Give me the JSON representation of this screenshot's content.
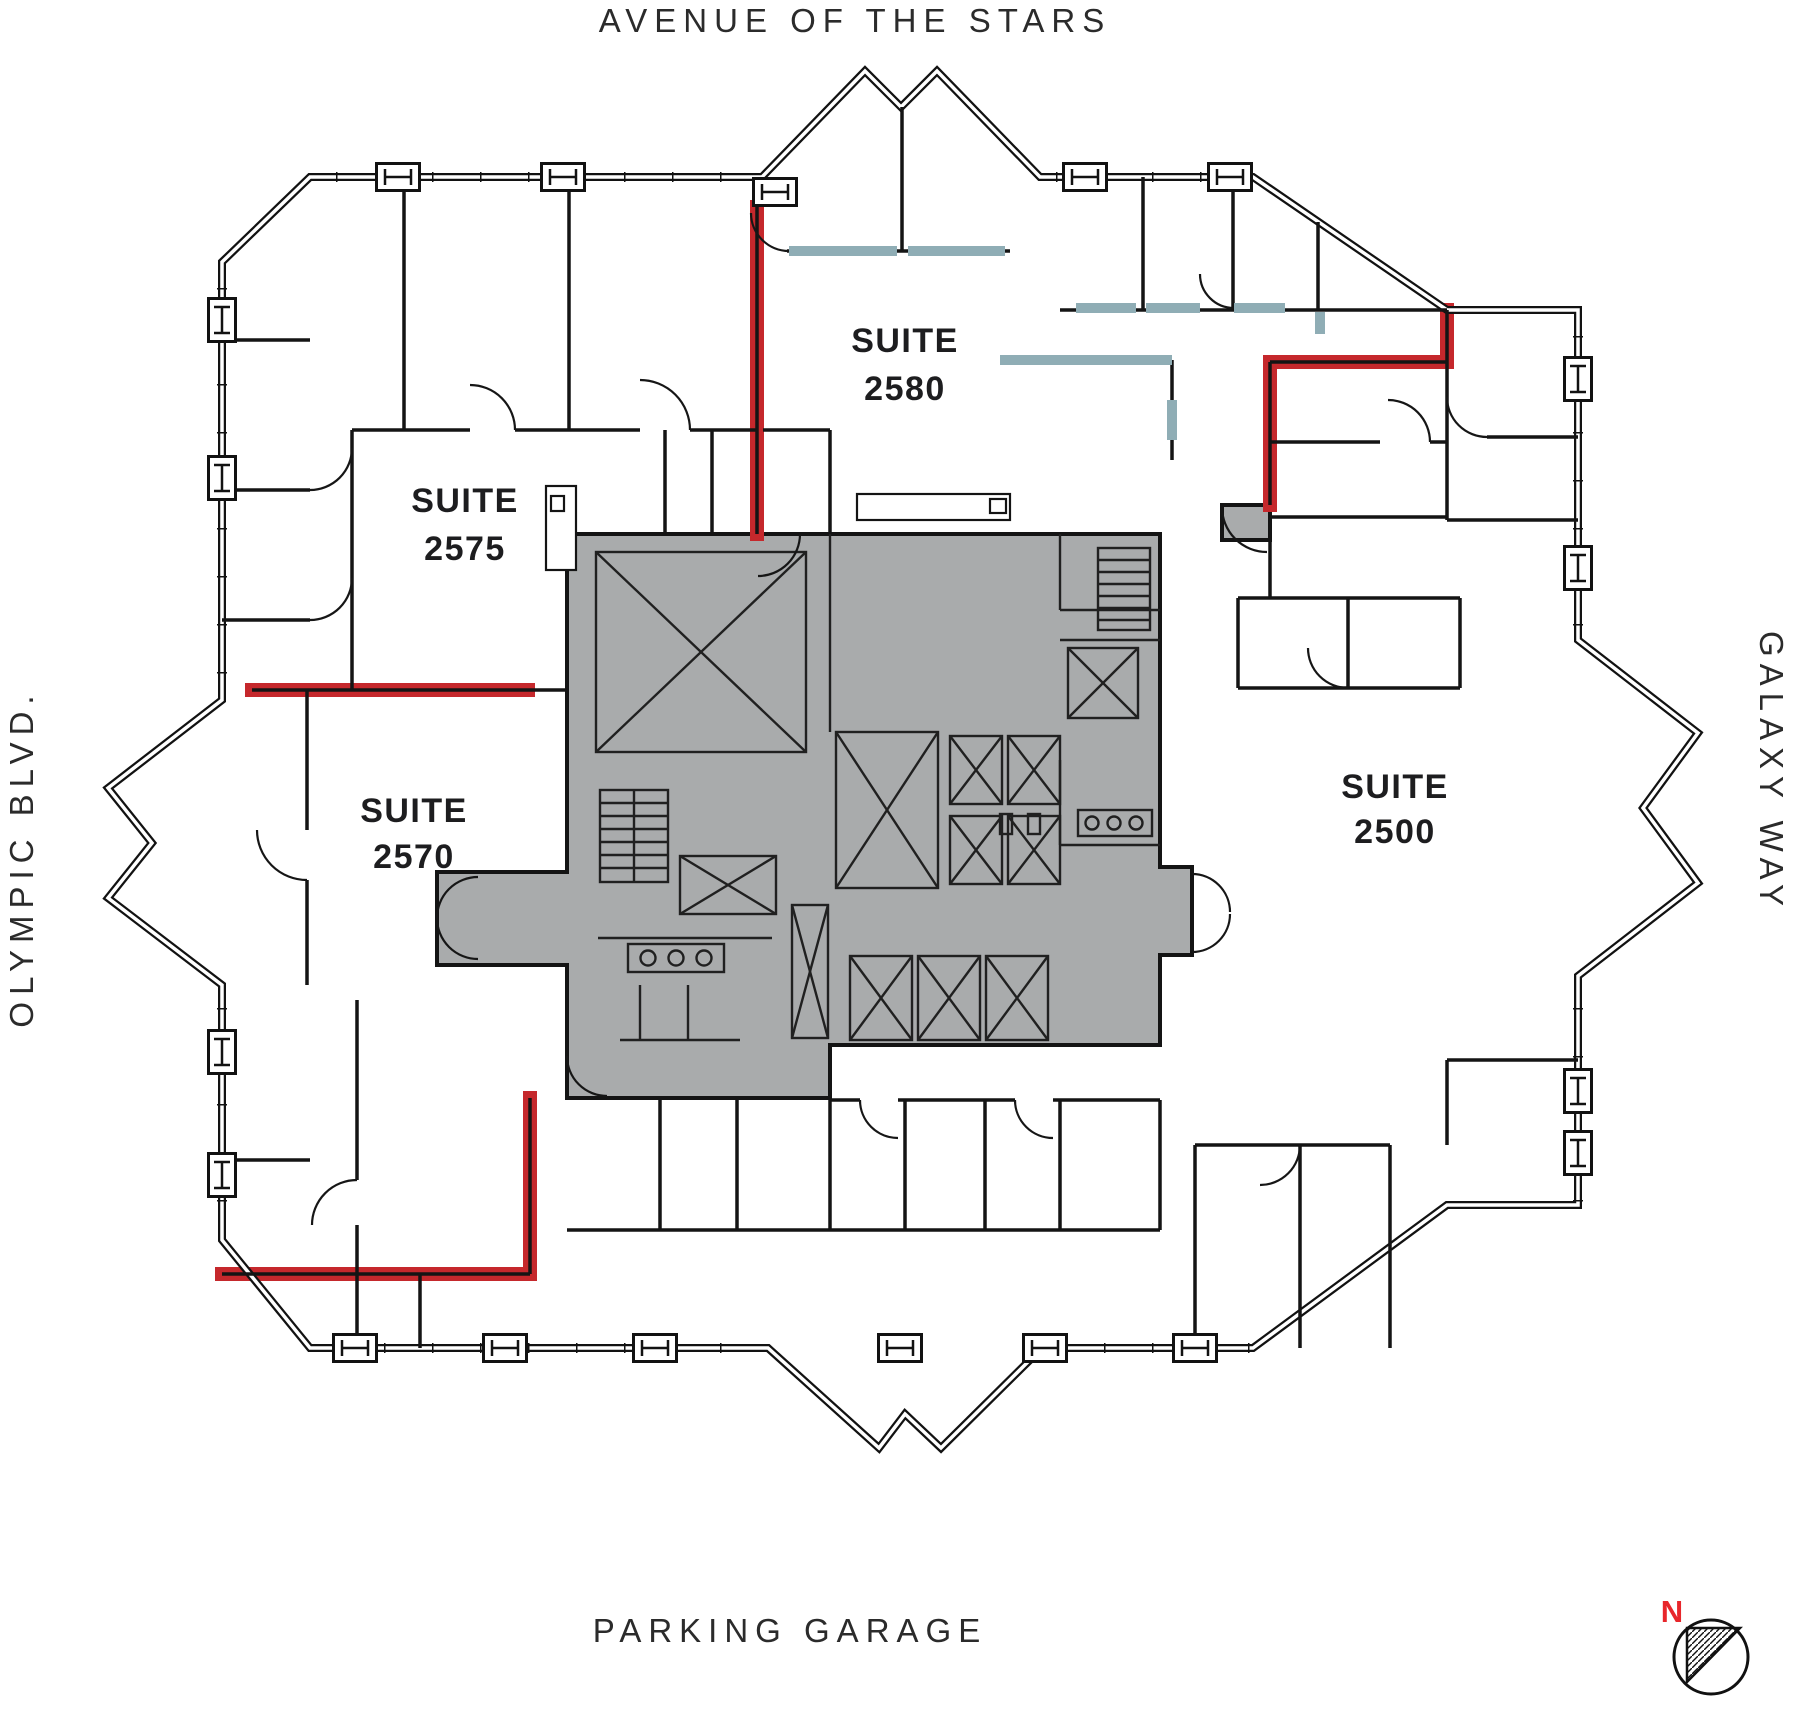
{
  "streets": {
    "top": "AVENUE OF THE STARS",
    "bottom": "PARKING GARAGE",
    "left": "OLYMPIC BLVD.",
    "right": "GALAXY WAY"
  },
  "suites": [
    {
      "label": "SUITE",
      "number": "2580"
    },
    {
      "label": "SUITE",
      "number": "2575"
    },
    {
      "label": "SUITE",
      "number": "2570"
    },
    {
      "label": "SUITE",
      "number": "2500"
    }
  ],
  "compass": {
    "north_label": "N"
  },
  "colors": {
    "highlight_red": "#c5282c",
    "glass_teal": "#8fadb5",
    "core_gray": "#a9abac",
    "wall": "#121212",
    "suite_text": "#1d1d1f",
    "street_text": "#2b2b2b",
    "compass_red": "#e8262b"
  }
}
